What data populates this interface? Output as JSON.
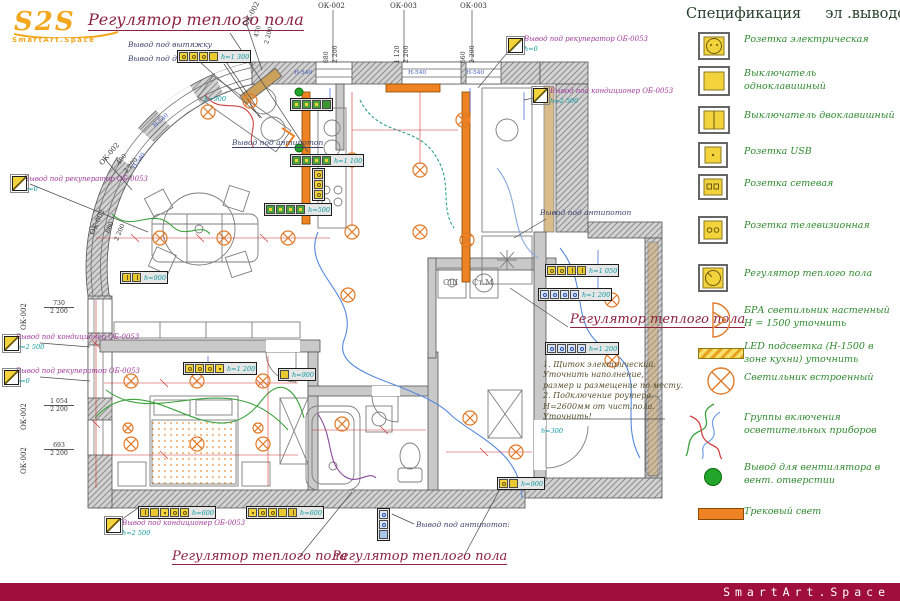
{
  "colors": {
    "accent_red": "#8e2140",
    "footer_bar": "#a00f3c",
    "device_yellow": "#f2d33c",
    "lamp_orange": "#ef8222",
    "legend_green": "#2f8a2f",
    "vent_green": "#22a52a"
  },
  "branding": {
    "logo_text": "S2S",
    "logo_sub": "SmartArt.Space",
    "footer": "SmartArt.Space"
  },
  "legend": {
    "title_left": "Спецификация",
    "title_mid": "эл .выводов",
    "colon": ":",
    "items": [
      {
        "icon": "socket-electric",
        "label": "Розетка электрическая"
      },
      {
        "icon": "switch-single",
        "label": "Выключатель одноклавишный"
      },
      {
        "icon": "switch-double",
        "label": "Выключатель двоклавишный"
      },
      {
        "icon": "socket-usb",
        "label": "Розетка USB"
      },
      {
        "icon": "socket-network",
        "label": "Розетка сетевая"
      },
      {
        "icon": "socket-tv",
        "label": "Розетка телевизионная"
      },
      {
        "icon": "floor-heating-regulator",
        "label": "Регулятор теплого пола"
      },
      {
        "icon": "wall-sconce",
        "label": "БРА светильник настенный H = 1500 уточнить"
      },
      {
        "icon": "led-strip",
        "label": "LED подсветка (Н-1500 в зоне кухни) уточнить"
      },
      {
        "icon": "recessed-light",
        "label": "Светильник встроенный"
      },
      {
        "icon": "switch-groups",
        "label": "Группы включения осветительных приборов"
      },
      {
        "icon": "fan-outlet",
        "label": "Вывод для вентилятора в вент. отверстии"
      },
      {
        "icon": "track-light",
        "label": "Трековый свет"
      }
    ]
  },
  "plan": {
    "labels": {
      "regulator_top": "Регулятор теплого пола",
      "regulator_mid": "Регулятор теплого пола",
      "regulator_bottom_left": "Регулятор теплого пола",
      "regulator_bottom_right": "Регулятор теплого пола",
      "hood": "Вывод под вытяжку",
      "oven": "Вывод под духовку+СВЧ",
      "recuperator_top": "Вывод под рекуператор ОБ-0053",
      "recuperator_top_h": "h=0",
      "cond_right": "Вывод под кондиционер ОБ-0053",
      "cond_right_h": "h=2 500",
      "recuperator_left": "Вывод под рекуператор ОБ-0053",
      "recuperator_left_h": "h=0",
      "cond_left": "Вывод под кондиционер ОБ-0053",
      "cond_left_h": "h=2 500",
      "recuperator_left2": "Вывод под рекуператор ОБ-0053",
      "recuperator_left2_h": "h=0",
      "cond_bottom": "Вывод под кондиционер ОБ-0053",
      "cond_bottom_h": "h=2 500",
      "antipotop_mid": "Вывод под антипотоп",
      "antipotop_right": "Вывод под антипотоп",
      "antipotop_bottom": "Вывод под антипотоп:",
      "laundry_sh": "СШ",
      "laundry_stm": "Ст.М"
    },
    "note_lines": [
      "1. Щиток электрический.",
      "Уточнить наполнение,",
      "размер и размещение по месту.",
      "2. Подключение роутера.",
      "Н=2600мм от чист.пола.",
      "Уточнить!"
    ],
    "tags": {
      "r1": "h=1 300",
      "r3": "h=1 100",
      "r4": "h=500",
      "sw": "h=900",
      "stool": "h=900",
      "bed": "h=1 200",
      "door": "h=900",
      "r9": "h=1 050",
      "r10": "h=1 200",
      "r11": "h=1 200",
      "b1": "h=600",
      "b2": "h=600",
      "hall": "h=900",
      "s300": "h=300"
    },
    "sill": "Н-540",
    "windows": {
      "top": [
        {
          "code": "ОК-002",
          "w": "680",
          "h": "2 200"
        },
        {
          "code": "ОК-003",
          "w": "1 120",
          "h": "2 200"
        },
        {
          "code": "ОК-003",
          "w": "660",
          "h": "2 200"
        }
      ],
      "arc": [
        {
          "code": "ОК-002",
          "w": "470",
          "h": "2 200"
        },
        {
          "code": "ОК-002",
          "w": "480",
          "h": "2 200"
        },
        {
          "code": "ОК-002",
          "w": "680",
          "h": "2 200"
        }
      ],
      "left": [
        {
          "code": "ОК-002",
          "w": "730",
          "h": "2 200"
        },
        {
          "code": "ОК-002",
          "w": "1 054",
          "h": "2 200"
        },
        {
          "code": "ОК-002",
          "w": "693",
          "h": "2 200"
        }
      ]
    }
  }
}
